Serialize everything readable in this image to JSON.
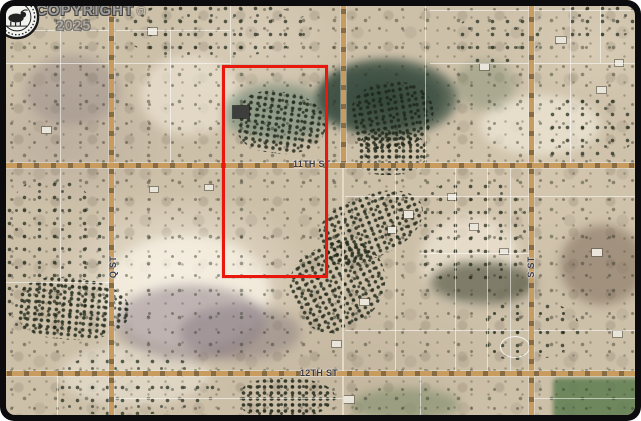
{
  "watermark": {
    "text": "COPYRIGHT",
    "symbol": "©",
    "year": "2025"
  },
  "streets": {
    "eleventh": "11TH ST",
    "twelfth": "12TH ST",
    "q": "Q ST",
    "s": "S ST"
  },
  "icons": {
    "seal": "realtor-board-seal-icon",
    "copyright": "copyright-symbol-icon"
  },
  "colors": {
    "property_outline_red": "#ea170d",
    "road_tan": "#c79c5e",
    "frame_black": "#0c0c0e",
    "terrain_tan": "#cdc0a9",
    "pond_green": "#3c5245",
    "field_green": "#5d7c50",
    "parcel_line_white": "#ffffff",
    "street_label_gray": "#3a3a44",
    "watermark_gray": "#9c9c9c"
  }
}
